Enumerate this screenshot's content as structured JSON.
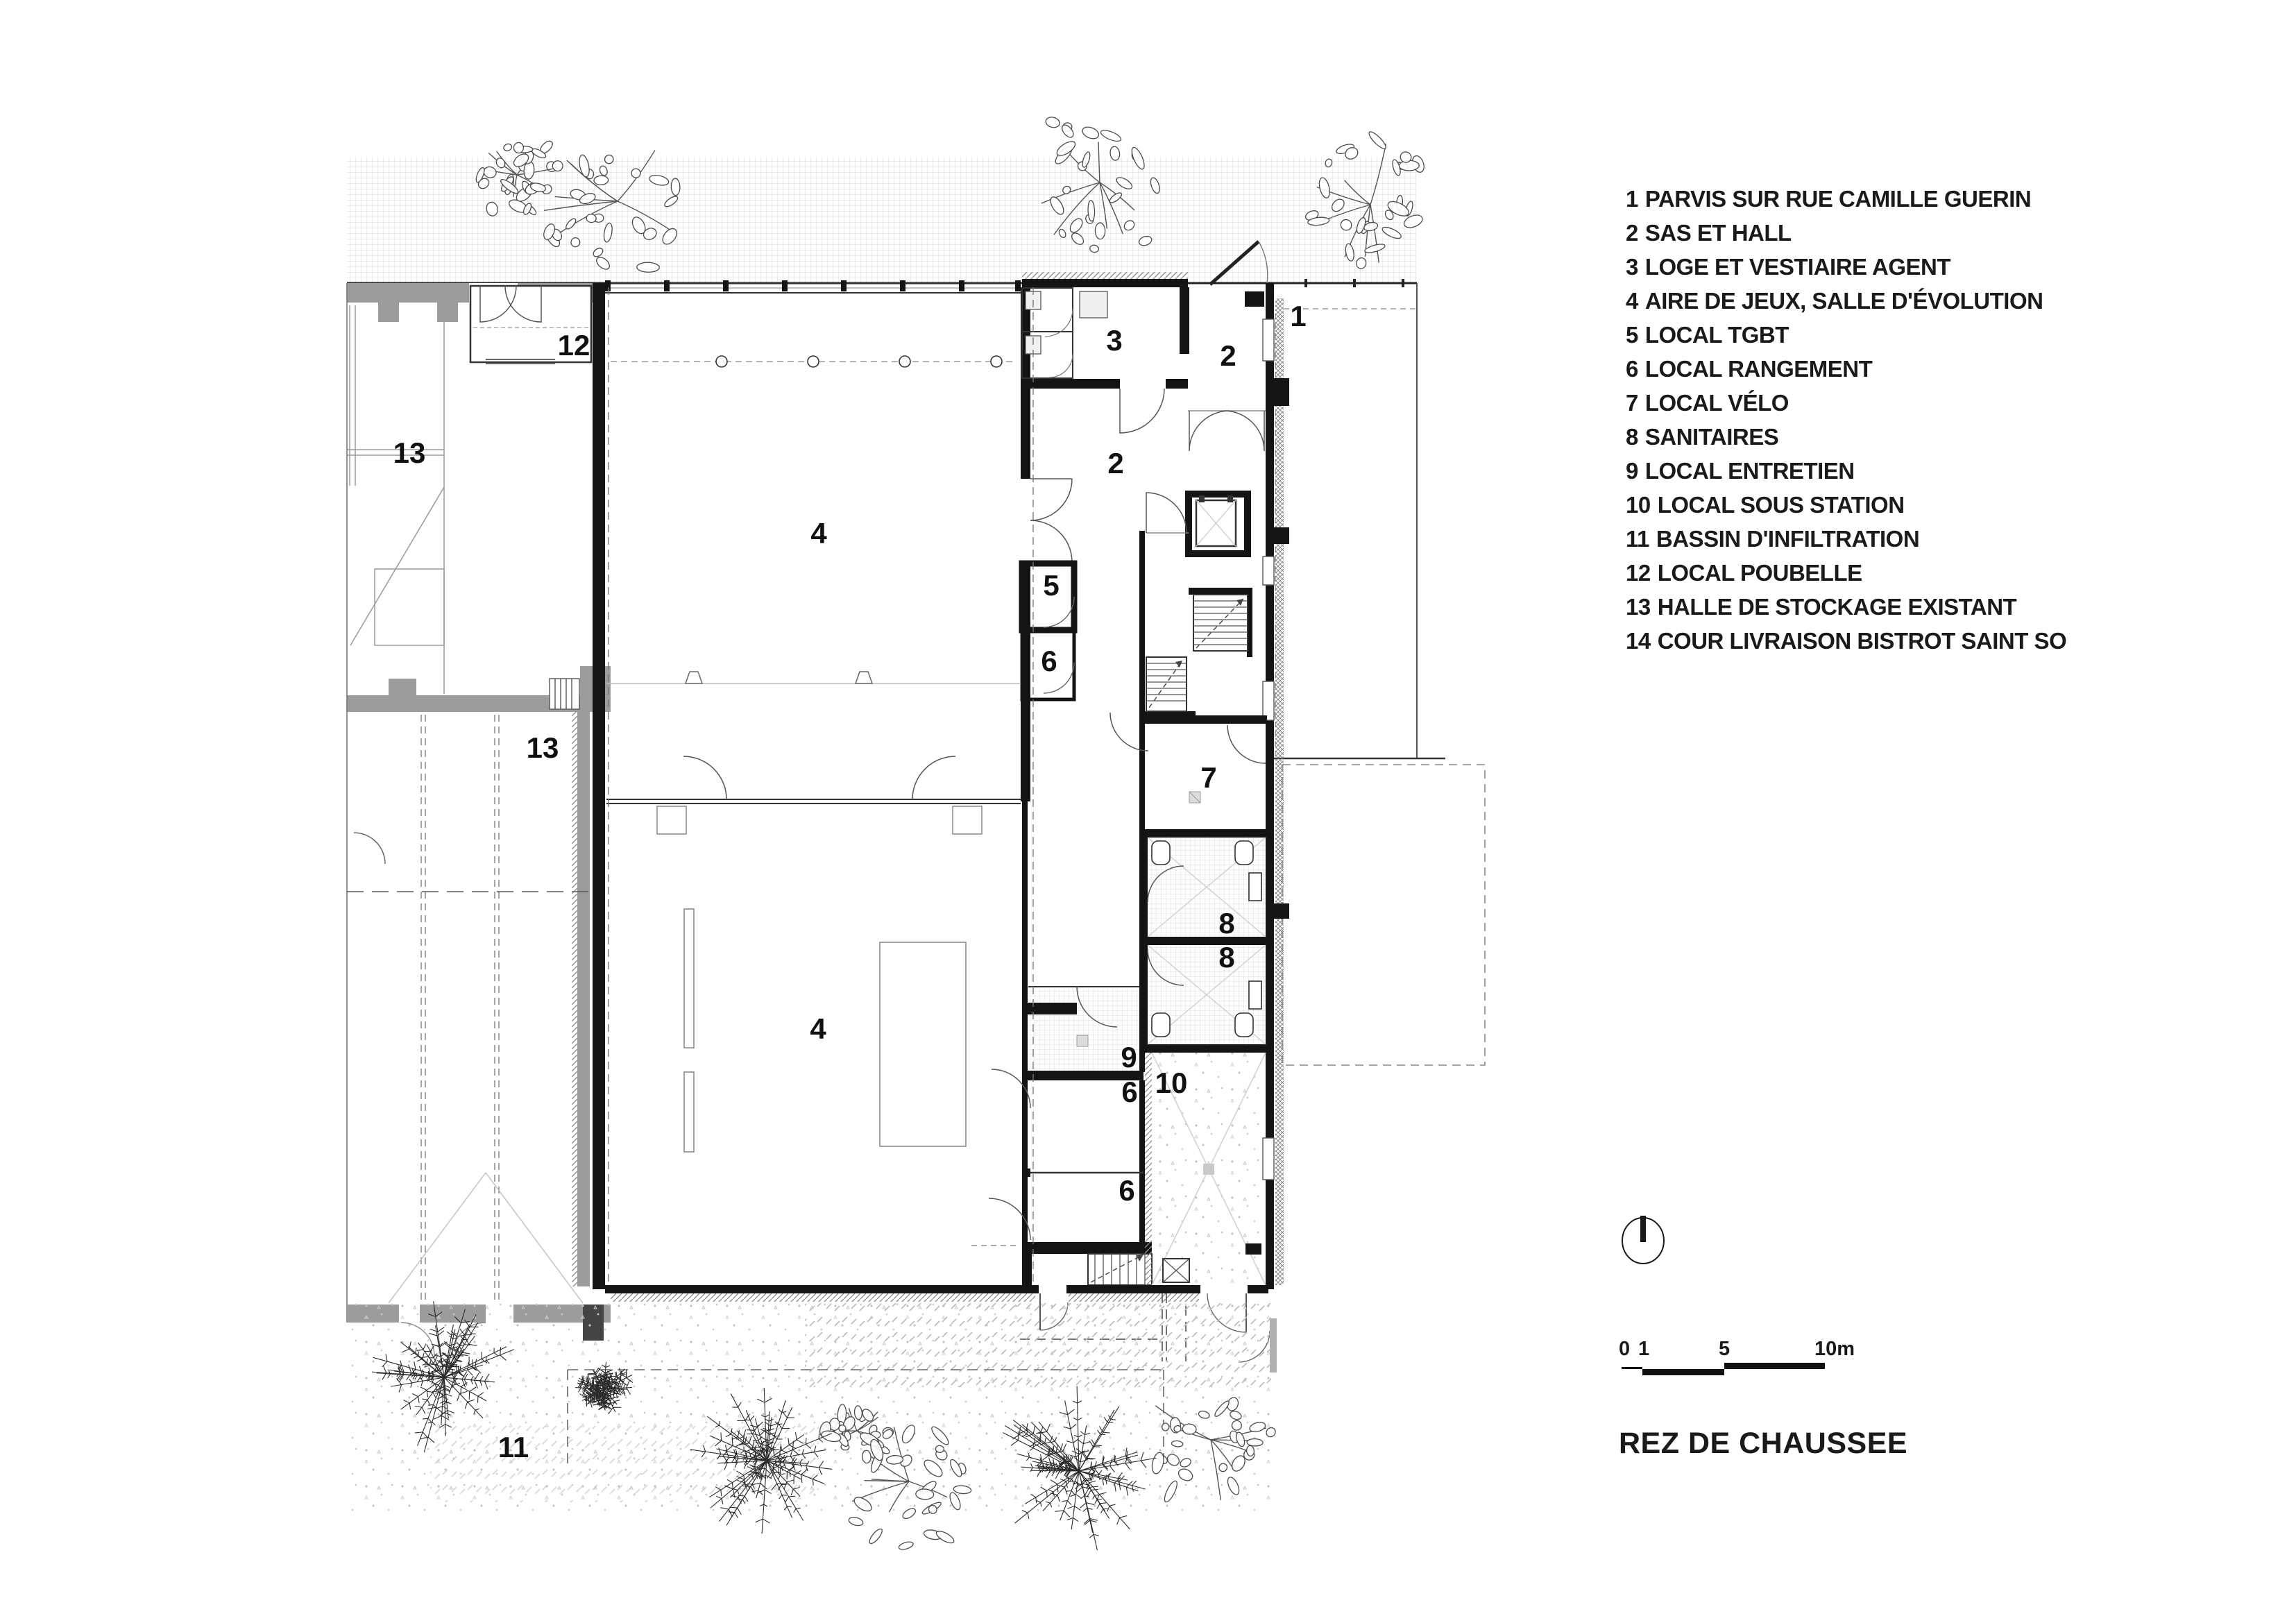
{
  "title": "REZ DE CHAUSSEE",
  "legend": {
    "items": [
      {
        "num": "1",
        "label": "PARVIS SUR RUE CAMILLE GUERIN"
      },
      {
        "num": "2",
        "label": "SAS ET HALL"
      },
      {
        "num": "3",
        "label": "LOGE ET VESTIAIRE AGENT"
      },
      {
        "num": "4",
        "label": "AIRE DE JEUX, SALLE D'ÉVOLUTION"
      },
      {
        "num": "5",
        "label": "LOCAL TGBT"
      },
      {
        "num": "6",
        "label": "LOCAL RANGEMENT"
      },
      {
        "num": "7",
        "label": "LOCAL VÉLO"
      },
      {
        "num": "8",
        "label": "SANITAIRES"
      },
      {
        "num": "9",
        "label": "LOCAL ENTRETIEN"
      },
      {
        "num": "10",
        "label": "LOCAL SOUS STATION"
      },
      {
        "num": "11",
        "label": "BASSIN D'INFILTRATION"
      },
      {
        "num": "12",
        "label": "LOCAL POUBELLE"
      },
      {
        "num": "13",
        "label": "HALLE DE STOCKAGE EXISTANT"
      },
      {
        "num": "14",
        "label": "COUR LIVRAISON BISTROT SAINT SO"
      }
    ]
  },
  "scalebar": {
    "t0": "0",
    "t1": "1",
    "t5": "5",
    "t10": "10m"
  },
  "plan": {
    "labels": [
      {
        "t": "1"
      },
      {
        "t": "2"
      },
      {
        "t": "3"
      },
      {
        "t": "2"
      },
      {
        "t": "4"
      },
      {
        "t": "5"
      },
      {
        "t": "6"
      },
      {
        "t": "12"
      },
      {
        "t": "13"
      },
      {
        "t": "13"
      },
      {
        "t": "7"
      },
      {
        "t": "8"
      },
      {
        "t": "8"
      },
      {
        "t": "9"
      },
      {
        "t": "10"
      },
      {
        "t": "6"
      },
      {
        "t": "6"
      },
      {
        "t": "4"
      },
      {
        "t": "11"
      }
    ]
  },
  "colors": {
    "ink": "#1a1a1a",
    "wall": "#141414",
    "gray_wall": "#9c9c9c",
    "paper": "#ffffff"
  }
}
